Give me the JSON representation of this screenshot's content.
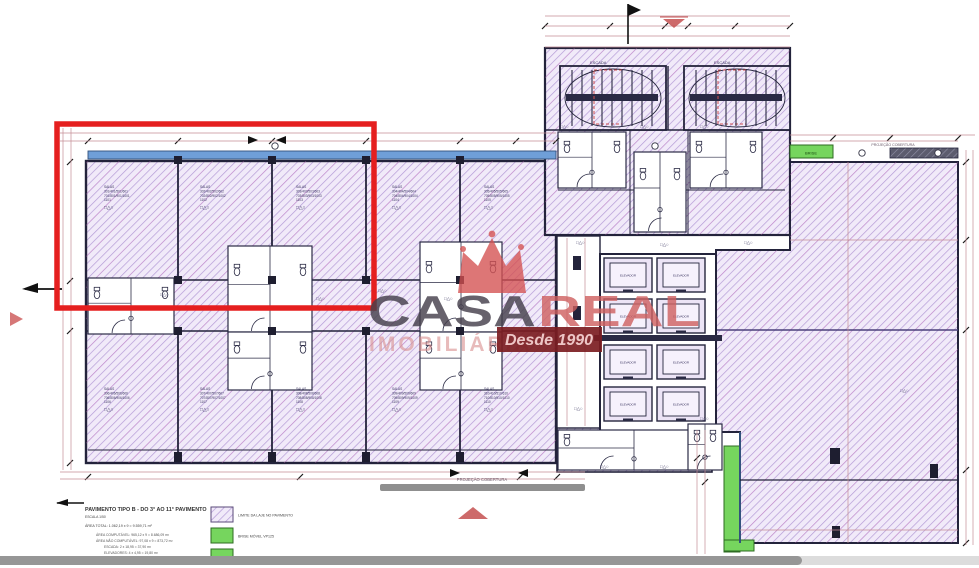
{
  "watermark": {
    "brand_part1": "CASA",
    "brand_part2": "REAL",
    "sub": "IMOBILIÁRIA",
    "badge": "Desde 1990"
  },
  "title_block": {
    "title": "PAVIMENTO TIPO B - DO 3° AO 11° PAVIMENTO",
    "scale": "ESCALA 1/50",
    "area_total": "ÁREA TOTAL: 1.062,19 x 9 = 9.559,71 m²",
    "detail_lines": [
      "ÁREA COMPUTÁVEL: 965,12 x 9 = 8.686,09 m²",
      "ÁREA NÃO COMPUTÁVEL: 97,08 x 9 = 873,72 m²",
      "ESCADA: 2 x 18,95 = 37,90 m²",
      "ELEVADORES: 4 x 4,95 = 19,80 m²"
    ]
  },
  "legend": {
    "items": [
      {
        "swatch": "hatch-purple",
        "label": "LIMITE DA LAJE NO PAVIMENTO"
      },
      {
        "swatch": "green",
        "label": "BRISE MÓVEL VP125"
      },
      {
        "swatch": "green",
        "label": "BRISE SOB MEDIDA"
      }
    ]
  },
  "plan": {
    "projection_label": "PROJEÇÃO COBERTURA",
    "brise_label": "BRISE",
    "stair_label": "ESCADA",
    "elevator_label": "ELEVADOR",
    "symbols": "□△○",
    "rooms": [
      {
        "lines": [
          "SALAS",
          "301/401/501/601",
          "701/801/901/1001",
          "1101"
        ]
      },
      {
        "lines": [
          "SALAS",
          "302/402/502/602",
          "702/802/902/1002",
          "1102"
        ]
      },
      {
        "lines": [
          "SALAS",
          "303/403/503/603",
          "703/803/903/1003",
          "1103"
        ]
      },
      {
        "lines": [
          "SALAS",
          "304/404/504/604",
          "704/804/904/1004",
          "1104"
        ]
      },
      {
        "lines": [
          "SALAS",
          "305/405/505/605",
          "705/805/905/1005",
          "1105"
        ]
      },
      {
        "lines": [
          "SALAS",
          "306/406/506/606",
          "706/806/906/1006",
          "1106"
        ]
      },
      {
        "lines": [
          "SALAS",
          "307/407/507/607",
          "707/807/907/1007",
          "1107"
        ]
      },
      {
        "lines": [
          "SALAS",
          "308/408/508/608",
          "708/808/908/1008",
          "1108"
        ]
      },
      {
        "lines": [
          "SALAS",
          "309/409/509/609",
          "709/809/909/1009",
          "1109"
        ]
      },
      {
        "lines": [
          "SALAS",
          "310/410/510/610",
          "710/810/910/1010",
          "1110"
        ]
      }
    ]
  },
  "colors": {
    "highlight_red": "#e51f1f",
    "hatch_purple": "#b49bd6",
    "wall_dark": "#23233b",
    "dimension_pink": "#c48d94",
    "facade_blue": "#6f9fd8",
    "brise_green": "#76d55e",
    "bar_gray": "#8f8f8f",
    "watermark_red": "#cf5f5f",
    "watermark_dark": "#46404c",
    "badge_bg": "#7c1d22"
  }
}
